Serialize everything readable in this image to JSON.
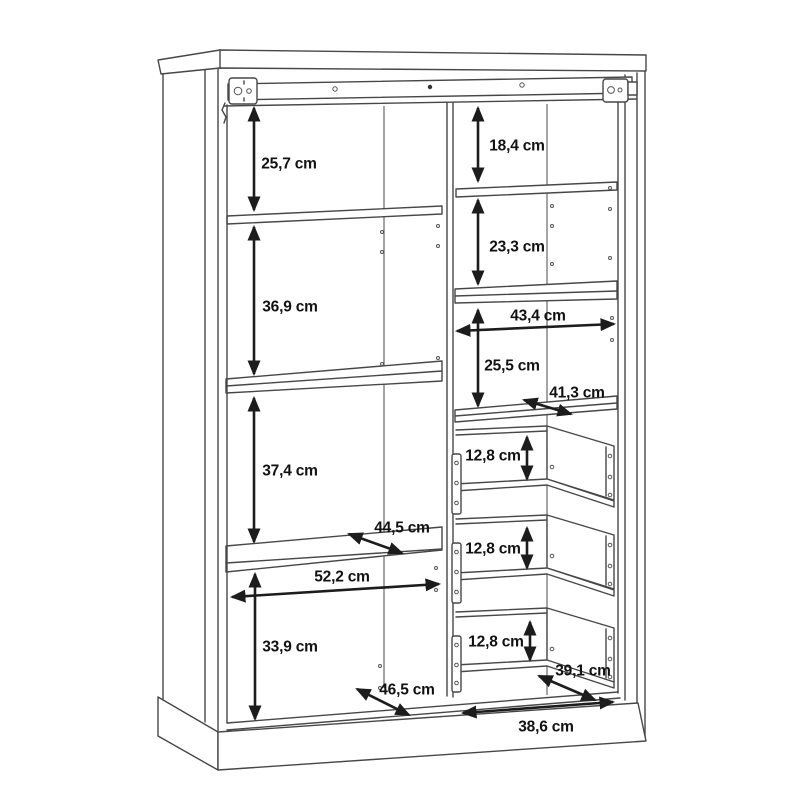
{
  "diagram": {
    "unit": "cm",
    "colors": {
      "line": "#474747",
      "arrow": "#1c1c1c",
      "text": "#111111",
      "background": "#ffffff"
    }
  },
  "dims": {
    "left": {
      "section_heights": [
        "25,7 cm",
        "36,9 cm",
        "37,4 cm",
        "33,9 cm"
      ],
      "shelf_depth": "44,5 cm",
      "inner_width": "52,2 cm",
      "bottom_depth": "46,5 cm"
    },
    "right": {
      "section_heights": [
        "18,4 cm",
        "23,3 cm",
        "25,5 cm"
      ],
      "inner_width": "43,4 cm",
      "shelf_depth": "41,3 cm",
      "drawer_heights": [
        "12,8 cm",
        "12,8 cm",
        "12,8 cm"
      ],
      "drawer_depth": "39,1 cm",
      "bottom_inner_width": "38,6 cm"
    }
  }
}
